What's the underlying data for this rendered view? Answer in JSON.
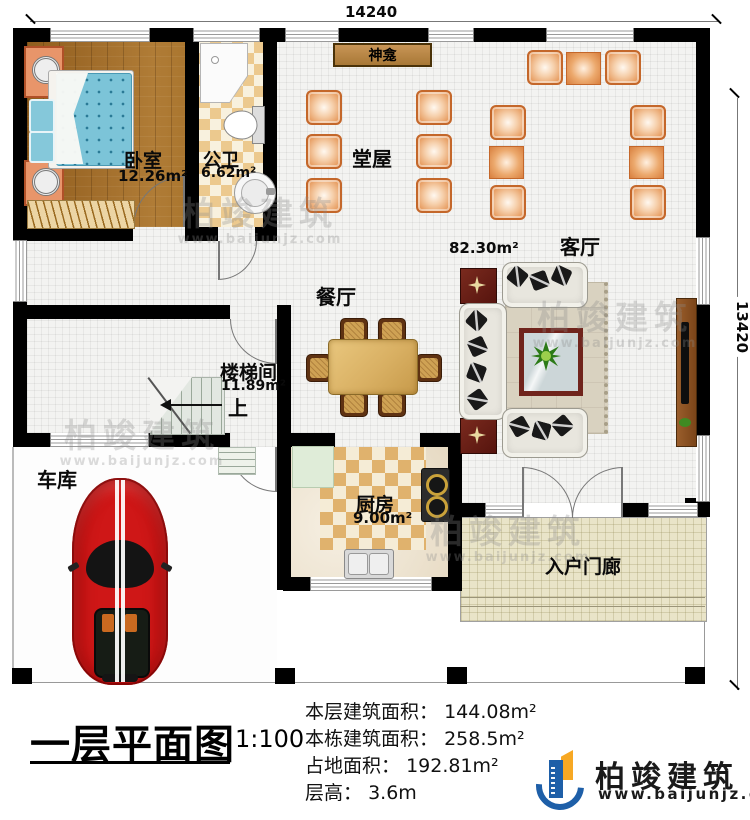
{
  "dimensions": {
    "top": "14240",
    "right": "13420"
  },
  "rooms": {
    "bedroom": {
      "name": "卧室",
      "area": "12.26m²"
    },
    "bathroom": {
      "name": "公卫",
      "area": "6.62m²"
    },
    "shrine": {
      "name": "神龛"
    },
    "hall": {
      "name": "堂屋"
    },
    "living_room": {
      "name": "客厅",
      "area": "82.30m²"
    },
    "dining_room": {
      "name": "餐厅"
    },
    "stairwell": {
      "name": "楼梯间",
      "area": "11.89m²",
      "direction": "上"
    },
    "garage": {
      "name": "车库"
    },
    "kitchen": {
      "name": "厨房",
      "area": "9.00m²"
    },
    "porch": {
      "name": "入户门廊"
    }
  },
  "title_block": {
    "title": "一层平面图",
    "scale": "1:100",
    "stats": [
      {
        "label": "本层建筑面积：",
        "value": "144.08m²"
      },
      {
        "label": "本栋建筑面积：",
        "value": "258.5m²"
      },
      {
        "label": "占地面积：",
        "value": "192.81m²"
      },
      {
        "label": "层高：",
        "value": "3.6m"
      }
    ]
  },
  "logo": {
    "company": "柏竣建筑",
    "website": "www.baijunjz.com"
  },
  "watermark": {
    "text": "柏竣建筑",
    "website": "www.baijunjz.com"
  },
  "colors": {
    "wall": "#000000",
    "chair": "#e69a5d",
    "wood_floor": "#a06c2a",
    "logo_blue": "#1e5fa8",
    "logo_orange": "#f7a823"
  }
}
